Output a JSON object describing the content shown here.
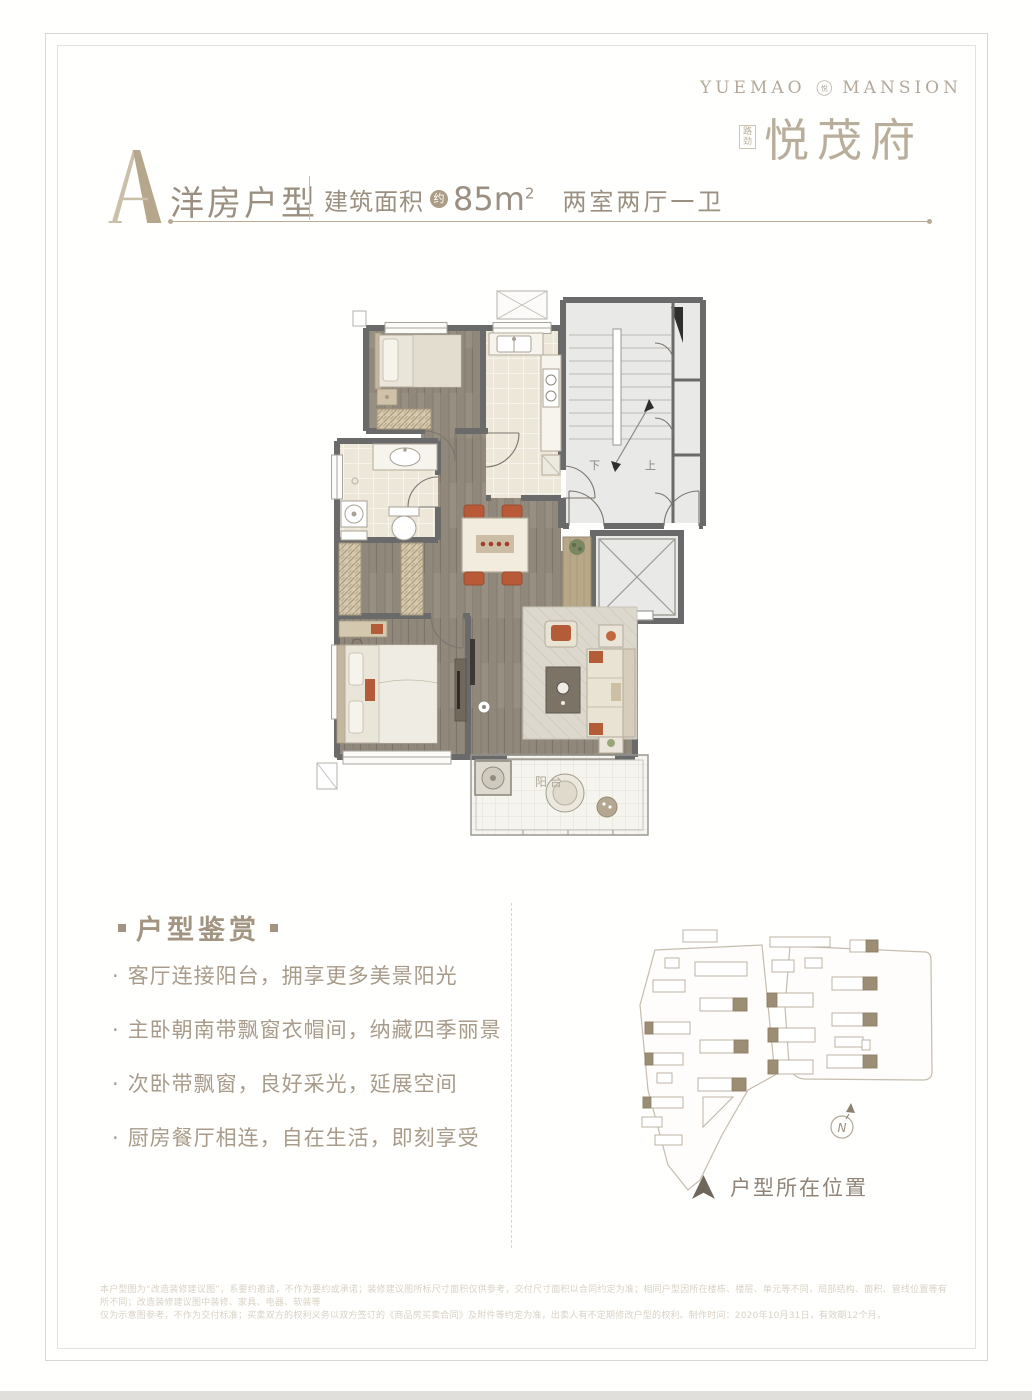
{
  "brand": {
    "name_left": "YUEMAO",
    "name_right": "MANSION",
    "emblem_char": "悦",
    "seal": "路劲",
    "cn_name": "悦茂府"
  },
  "title": {
    "unit_letter": "A",
    "unit_type": "洋房户型",
    "area_label": "建筑面积",
    "area_approx": "约",
    "area_value": "85m",
    "area_sup": "2",
    "layout": "两室两厅一卫"
  },
  "features": {
    "heading": "户型鉴赏",
    "bullet": "·",
    "items": [
      "客厅连接阳台，拥享更多美景阳光",
      "主卧朝南带飘窗衣帽间，纳藏四季丽景",
      "次卧带飘窗，良好采光，延展空间",
      "厨房餐厅相连，自在生活，即刻享受"
    ]
  },
  "floorplan": {
    "label_down": "下",
    "label_up": "上",
    "label_balcony": "阳台"
  },
  "siteplan": {
    "compass_letter": "N",
    "legend": "户型所在位置"
  },
  "disclaimer": {
    "line1": "本户型图为“改造装修建议图”，系要约邀请，不作为要约或承诺；装修建议图所标尺寸面积仅供参考，交付尺寸面积以合同约定为准；相同户型因所在楼栋、楼层、单元等不同，局部结构、面积、管线位置等有所不同；改造装修建议图中装修、家具、电器、软装等",
    "line2": "仅为示意图参考，不作为交付标准；买卖双方的权利义务以双方签订的《商品房买卖合同》及附件等约定为准，出卖人有不定期修改户型的权利。制作时间：2020年10月31日，有效期12个月。"
  },
  "colors": {
    "accent_taupe": "#b5a68c",
    "text_warmgrey": "#9a8f80",
    "wall_grey": "#696a69",
    "wood_floor": "#90887b",
    "orange_furniture": "#b85a38",
    "highlight_building": "#9c8d75"
  }
}
